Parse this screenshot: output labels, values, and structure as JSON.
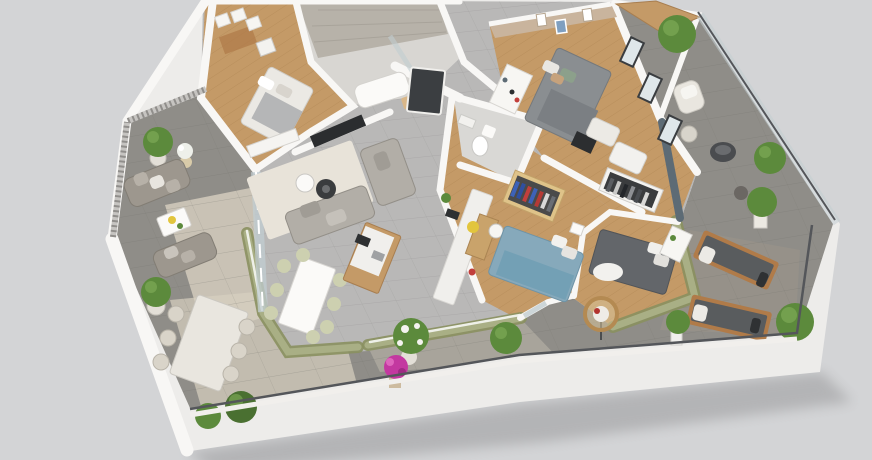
{
  "scene": {
    "type": "3d-isometric-floor-plan-render",
    "subject": "apartment cutaway dollhouse view with wrap-around terraces",
    "view": "isometric from above, rotated",
    "background": "plain light gray",
    "rooms": [
      {
        "id": "living-room",
        "floor": "gray tile",
        "features": [
          "L-shaped gray sofa",
          "cream rug",
          "round coffee tables",
          "wall TV"
        ]
      },
      {
        "id": "kitchen",
        "floor": "gray tile",
        "features": [
          "wood island with white top",
          "long white wall counter",
          "cooktop",
          "red coffee machine"
        ]
      },
      {
        "id": "dining-area",
        "floor": "gray tile",
        "features": [
          "white table",
          "sage green chairs"
        ]
      },
      {
        "id": "entry-hall",
        "features": [
          "dark front door"
        ]
      },
      {
        "id": "bathroom",
        "features": [
          "concrete tile walls",
          "glass shower",
          "white tub",
          "wood bench"
        ]
      },
      {
        "id": "wc",
        "features": [
          "toilet",
          "hand basin"
        ]
      },
      {
        "id": "storage-laundry",
        "features": [
          "white storage boxes",
          "shelving"
        ]
      },
      {
        "id": "bedroom-1",
        "floor": "wood",
        "features": [
          "double bed with white and gray bedding",
          "white sideboard"
        ]
      },
      {
        "id": "master-bedroom",
        "floor": "wood",
        "features": [
          "gray double bed",
          "beige accent wall with art",
          "white shelving",
          "dressing area",
          "wardrobe with gray clothes",
          "black drawers"
        ]
      },
      {
        "id": "bedroom-2",
        "floor": "wood",
        "features": [
          "blue double bed",
          "desk with yellow chair",
          "open wardrobe with blue and red clothes"
        ]
      },
      {
        "id": "bedroom-3",
        "floor": "wood",
        "features": [
          "dark gray double bed",
          "white shelf unit"
        ]
      },
      {
        "id": "left-terrace",
        "features": [
          "two outdoor sofas",
          "white coffee table",
          "potted tree",
          "white flowers",
          "lattice railing"
        ]
      },
      {
        "id": "front-terrace",
        "features": [
          "outdoor dining table with six chairs",
          "green bushes",
          "pink flowering plant",
          "white flowering shrub"
        ]
      },
      {
        "id": "right-terrace",
        "features": [
          "two wood sun loungers with dark cushions",
          "hanging rattan egg chair",
          "potted shrubs"
        ]
      },
      {
        "id": "balcony",
        "features": [
          "wood deck strip",
          "cream armchair",
          "pouf",
          "dark bowl chair",
          "potted trees",
          "glass railing"
        ]
      }
    ]
  },
  "colors": {
    "bg": "#d3d4d6",
    "slab": "#edecea",
    "wall": "#f8f7f5",
    "paving": "#8f8d88",
    "paving_light": "#d7d0c1",
    "tile": "#b9b8b7",
    "wood": "#c49a67",
    "olive": "#a9af85",
    "olive_dark": "#8a905f",
    "rug": "#e8e3d9",
    "sofa": "#b2aea7",
    "sofa_outdoor": "#9d978e",
    "bed_gray": "#8a8e91",
    "bed_blue": "#86a9bb",
    "bed_dark": "#63666a",
    "bed_white": "#ebe9e4",
    "door": "#3b3e41",
    "tv": "#2b2d2f",
    "glass": "#c2cdd1",
    "railing": "#54565a",
    "green": "#5c8a3c",
    "green_light": "#79a552",
    "pot": "#e3dfd7",
    "pink": "#c338a0",
    "wood_furn": "#b07b49",
    "counter": "#f0efec",
    "chair_sage": "#cdd0b0",
    "chair_yellow": "#e2c53d",
    "slate": "#5d6b75",
    "beige": "#c9b49d",
    "concrete": "#b7b2a9",
    "blue_cloth": "#3d62b8",
    "red_cloth": "#c23f3c",
    "cushion": "#595c5e",
    "white": "#f4f3f1"
  }
}
